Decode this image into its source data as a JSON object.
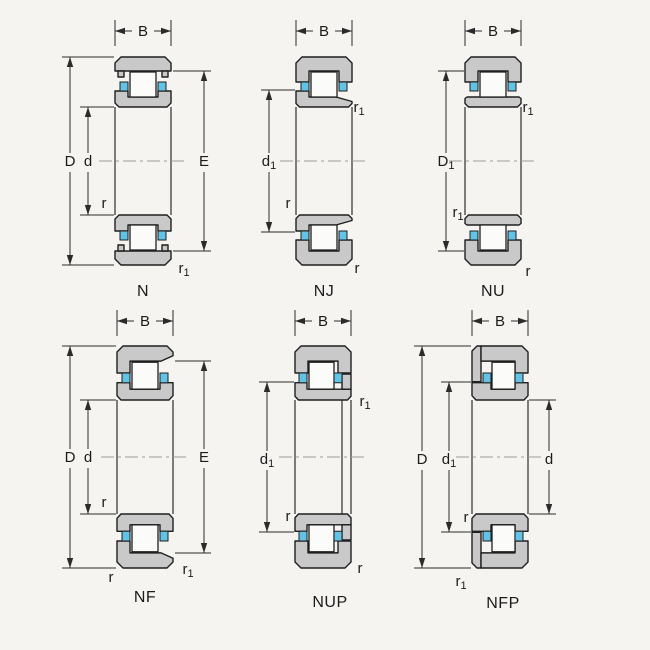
{
  "figure_title": "Cylindrical roller bearing types - cross sections",
  "colors": {
    "background": "#f5f4f1",
    "ring_fill": "#c9c9c9",
    "roller_fill": "#fbfbf9",
    "cage_fill": "#62c3e6",
    "outline": "#1f1f1f",
    "dimension": "#2b2b2b",
    "centerline": "#9b9b9b",
    "text": "#1b1b1b"
  },
  "diagrams": {
    "n": {
      "name": "N",
      "labels": {
        "width": {
          "base": "B",
          "sub": ""
        },
        "outer_dia": {
          "base": "D",
          "sub": ""
        },
        "bore": {
          "base": "d",
          "sub": ""
        },
        "raceway": {
          "base": "E",
          "sub": ""
        },
        "fillet_inner": {
          "base": "r",
          "sub": ""
        },
        "fillet_outer": {
          "base": "r",
          "sub": "1"
        }
      }
    },
    "nj": {
      "name": "NJ",
      "labels": {
        "width": {
          "base": "B",
          "sub": ""
        },
        "rib_dia": {
          "base": "d",
          "sub": "1"
        },
        "fillet_inner": {
          "base": "r",
          "sub": ""
        },
        "fillet_top": {
          "base": "r",
          "sub": "1"
        },
        "fillet_bottom": {
          "base": "r",
          "sub": ""
        }
      }
    },
    "nu": {
      "name": "NU",
      "labels": {
        "width": {
          "base": "B",
          "sub": ""
        },
        "rib_dia": {
          "base": "D",
          "sub": "1"
        },
        "fillet_inner": {
          "base": "r",
          "sub": "1"
        },
        "fillet_top": {
          "base": "r",
          "sub": "1"
        },
        "fillet_bottom": {
          "base": "r",
          "sub": ""
        }
      }
    },
    "nf": {
      "name": "NF",
      "labels": {
        "width": {
          "base": "B",
          "sub": ""
        },
        "outer_dia": {
          "base": "D",
          "sub": ""
        },
        "bore": {
          "base": "d",
          "sub": ""
        },
        "raceway": {
          "base": "E",
          "sub": ""
        },
        "fillet_inner": {
          "base": "r",
          "sub": ""
        },
        "fillet_bl": {
          "base": "r",
          "sub": ""
        },
        "fillet_br": {
          "base": "r",
          "sub": "1"
        }
      }
    },
    "nup": {
      "name": "NUP",
      "labels": {
        "width": {
          "base": "B",
          "sub": ""
        },
        "rib_dia": {
          "base": "d",
          "sub": "1"
        },
        "fillet_inner": {
          "base": "r",
          "sub": ""
        },
        "fillet_top": {
          "base": "r",
          "sub": "1"
        },
        "fillet_bottom": {
          "base": "r",
          "sub": ""
        }
      }
    },
    "nfp": {
      "name": "NFP",
      "labels": {
        "width": {
          "base": "B",
          "sub": ""
        },
        "outer_dia": {
          "base": "D",
          "sub": ""
        },
        "rib_dia": {
          "base": "d",
          "sub": "1"
        },
        "bore": {
          "base": "d",
          "sub": ""
        },
        "fillet_inner": {
          "base": "r",
          "sub": ""
        },
        "fillet_bl": {
          "base": "r",
          "sub": "1"
        }
      }
    }
  }
}
